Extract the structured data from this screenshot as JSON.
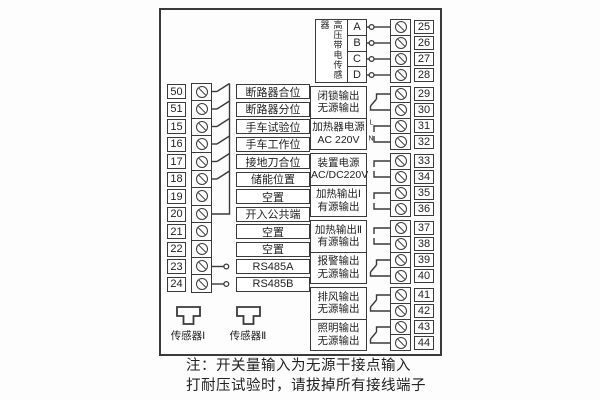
{
  "diagram": {
    "left_inputs": {
      "rows": [
        {
          "num": "50",
          "label": "断路器合位",
          "wire": "switch"
        },
        {
          "num": "51",
          "label": "断路器分位",
          "wire": "switch"
        },
        {
          "num": "15",
          "label": "手车试验位",
          "wire": "switch"
        },
        {
          "num": "16",
          "label": "手车工作位",
          "wire": "switch"
        },
        {
          "num": "17",
          "label": "接地刀合位",
          "wire": "switch"
        },
        {
          "num": "18",
          "label": "储能位置",
          "wire": "switch"
        },
        {
          "num": "19",
          "label": "空置",
          "wire": "none"
        },
        {
          "num": "20",
          "label": "开入公共端",
          "wire": "common"
        },
        {
          "num": "21",
          "label": "空置",
          "wire": "none"
        },
        {
          "num": "22",
          "label": "空置",
          "wire": "none"
        },
        {
          "num": "23",
          "label": "RS485A",
          "wire": "circle"
        },
        {
          "num": "24",
          "label": "RS485B",
          "wire": "circle"
        }
      ]
    },
    "right_outputs": {
      "sensor_block": {
        "label": "高压带电传感器",
        "channels": [
          {
            "name": "A",
            "num": "25"
          },
          {
            "name": "B",
            "num": "26"
          },
          {
            "name": "C",
            "num": "27"
          },
          {
            "name": "D",
            "num": "28"
          }
        ]
      },
      "blocks": [
        {
          "lines": [
            "闭锁输出",
            "无源输出"
          ],
          "terminals": [
            "29",
            "30"
          ],
          "wire": "switch"
        },
        {
          "lines": [
            "加热器电源",
            "AC 220V"
          ],
          "terminals": [
            "31",
            "32"
          ],
          "wire": "ln",
          "wire_labels": [
            "L",
            "N"
          ]
        },
        {
          "lines": [
            "装置电源",
            "AC/DC220V"
          ],
          "terminals": [
            "33",
            "34"
          ],
          "wire": "plain"
        },
        {
          "lines": [
            "加热输出Ⅰ",
            "有源输出"
          ],
          "terminals": [
            "35",
            "36"
          ],
          "wire": "plain"
        },
        {
          "lines": [
            "加热输出Ⅱ",
            "有源输出"
          ],
          "terminals": [
            "37",
            "38"
          ],
          "wire": "plain"
        },
        {
          "lines": [
            "报警输出",
            "无源输出"
          ],
          "terminals": [
            "39",
            "40"
          ],
          "wire": "switch"
        },
        {
          "lines": [
            "排风输出",
            "无源输出"
          ],
          "terminals": [
            "41",
            "42"
          ],
          "wire": "switch"
        },
        {
          "lines": [
            "照明输出",
            "无源输出"
          ],
          "terminals": [
            "43",
            "44"
          ],
          "wire": "switch"
        }
      ]
    },
    "sensors": [
      {
        "label": "传感器Ⅰ"
      },
      {
        "label": "传感器Ⅱ"
      }
    ],
    "notes": [
      "注：开关量输入为无源干接点输入",
      "打耐压试验时，请拔掉所有接线端子"
    ],
    "colors": {
      "line": "#3a3a3a",
      "text": "#222222",
      "background": "#ffffff"
    }
  }
}
